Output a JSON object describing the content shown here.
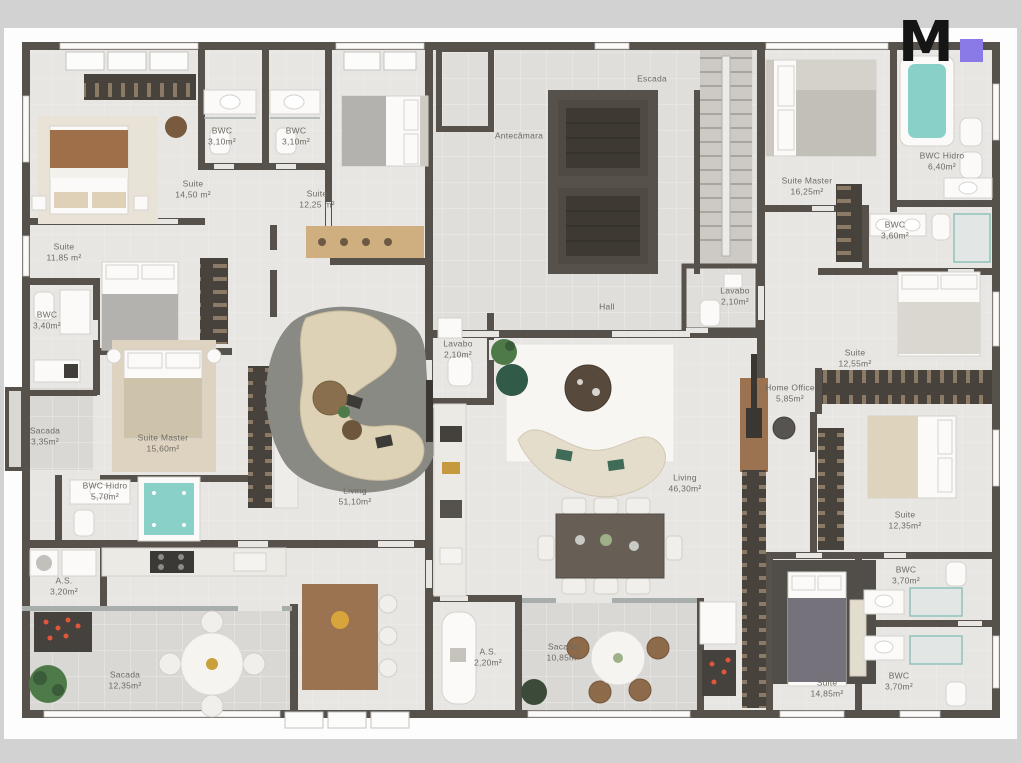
{
  "palette": {
    "gray-band": "#d2d2d2",
    "canvas": "#fdfdfd",
    "wall": "#57514c",
    "floor": "#e7e6e3",
    "floor-core": "#dfdedb",
    "balcony": "#d9d8d4",
    "label": "#6e6a63"
  },
  "logo": {
    "letter": "M",
    "square_color": "#8a7ae8"
  },
  "rooms": [
    {
      "name": "Suite",
      "area": "14,50 m²"
    },
    {
      "name": "BWC",
      "area": "3,10m²"
    },
    {
      "name": "BWC",
      "area": "3,10m²"
    },
    {
      "name": "Suite",
      "area": "12,25 m²"
    },
    {
      "name": "Suite",
      "area": "11,85 m²"
    },
    {
      "name": "BWC",
      "area": "3,40m²"
    },
    {
      "name": "Sacada",
      "area": "3,35m²"
    },
    {
      "name": "Suite Master",
      "area": "15,60m²"
    },
    {
      "name": "BWC Hidro",
      "area": "5,70m²"
    },
    {
      "name": "A.S.",
      "area": "3,20m²"
    },
    {
      "name": "Sacada",
      "area": "12,35m²"
    },
    {
      "name": "Living",
      "area": "51,10m²"
    },
    {
      "name": "Lavabo",
      "area": "2,10m²"
    },
    {
      "name": "Hall",
      "area": ""
    },
    {
      "name": "Antecâmara",
      "area": ""
    },
    {
      "name": "Escada",
      "area": ""
    },
    {
      "name": "Suite Master",
      "area": "16,25m²"
    },
    {
      "name": "BWC Hidro",
      "area": "6,40m²"
    },
    {
      "name": "BWC",
      "area": "3,60m²"
    },
    {
      "name": "Lavabo",
      "area": "2,10m²"
    },
    {
      "name": "Suite",
      "area": "12,55m²"
    },
    {
      "name": "Home Office",
      "area": "5,85m²"
    },
    {
      "name": "Living",
      "area": "46,30m²"
    },
    {
      "name": "Suite",
      "area": "12,35m²"
    },
    {
      "name": "BWC",
      "area": "3,70m²"
    },
    {
      "name": "Sacada",
      "area": "10,85m²"
    },
    {
      "name": "A.S.",
      "area": "2,20m²"
    },
    {
      "name": "Suite",
      "area": "14,85m²"
    },
    {
      "name": "BWC",
      "area": "3,70m²"
    }
  ]
}
